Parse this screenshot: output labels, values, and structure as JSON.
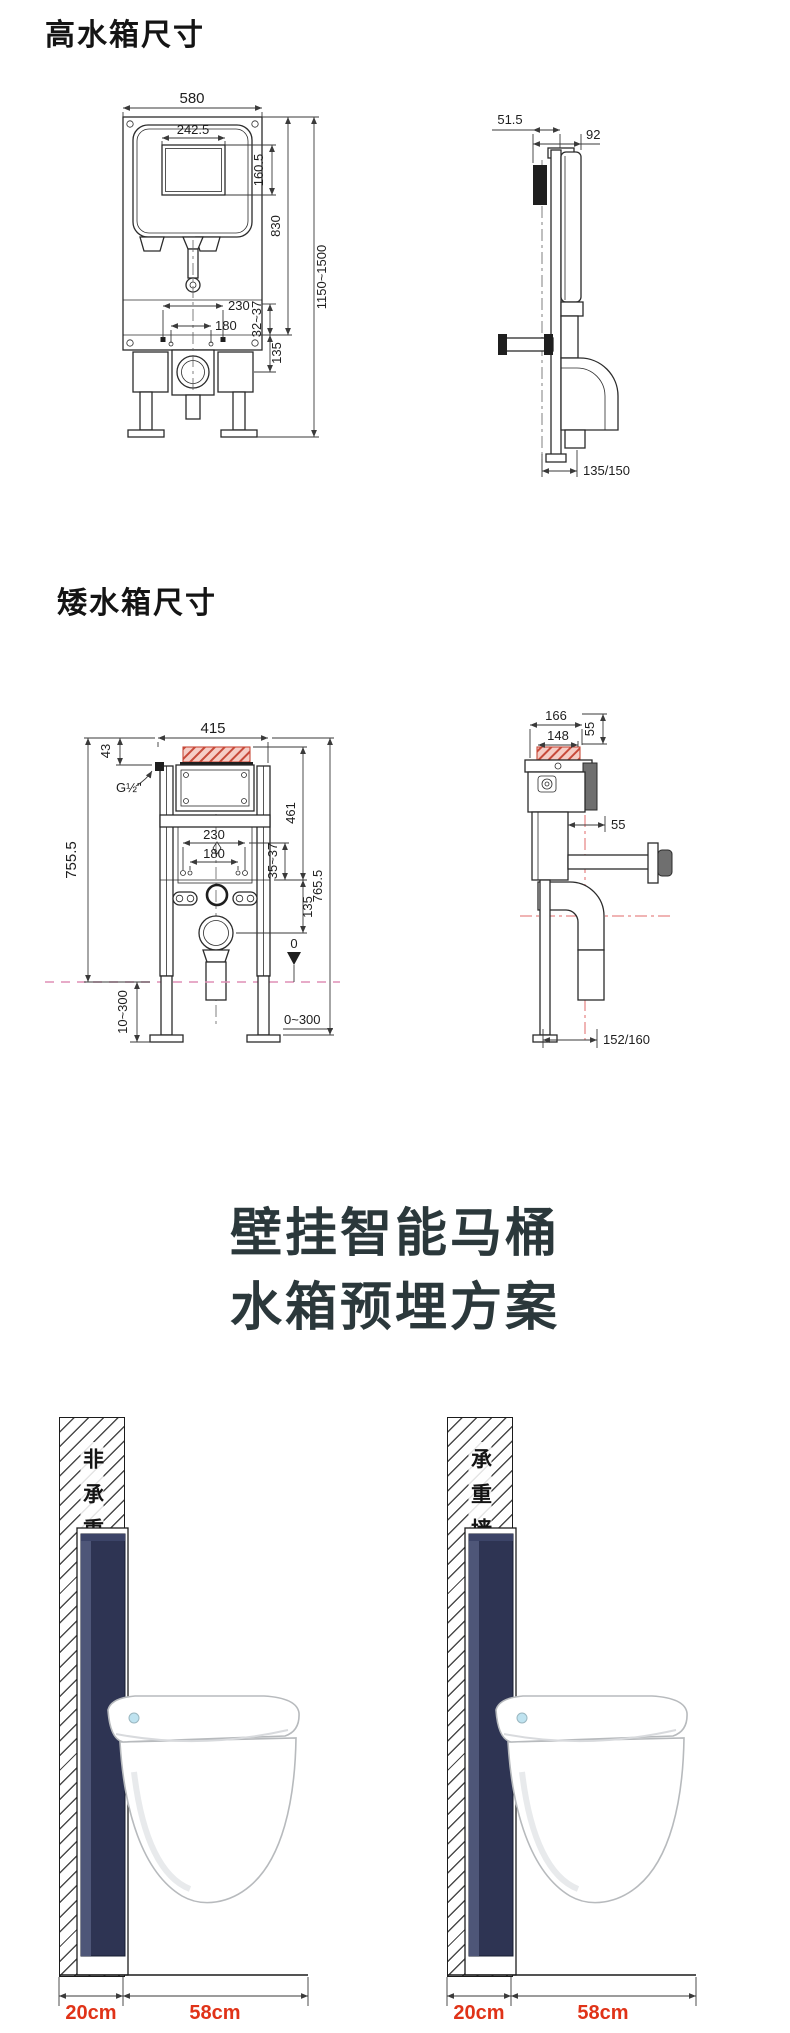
{
  "page": {
    "width": 790,
    "height": 2033
  },
  "high_tank": {
    "section_title": "高水箱尺寸",
    "front_view": {
      "overall_width": "580",
      "window_width": "242.5",
      "window_height": "160.5",
      "frame_height": "830",
      "install_height_range": "1150~1500",
      "bolt_spacing_outer": "230",
      "bolt_spacing_inner": "180",
      "adjust_range": "32~37",
      "rail_to_drain": "135"
    },
    "side_view": {
      "front_depth": "51.5",
      "total_depth": "92",
      "drain_distance": "135/150"
    }
  },
  "low_tank": {
    "section_title": "矮水箱尺寸",
    "front_view": {
      "overall_width": "415",
      "top_offset": "43",
      "inlet_thread": "G½\"",
      "bolt_spacing_outer": "230",
      "bolt_spacing_inner": "180",
      "adjust_range": "35~37",
      "tank_height": "461",
      "height_left": "755.5",
      "height_right": "765.5",
      "rail_to_drain": "135",
      "datum_level": "0",
      "leg_adjust_left": "10~300",
      "leg_adjust_right": "0~300"
    },
    "side_view": {
      "depth_outer": "166",
      "depth_inner": "148",
      "cap_height": "55",
      "rear_offset": "55",
      "drain_distance": "152/160"
    }
  },
  "embed_plan": {
    "title_line1": "壁挂智能马桶",
    "title_line2": "水箱预埋方案",
    "left_scheme": {
      "wall_label": "非承重墙或实心墙",
      "wall_thickness": "20cm",
      "toilet_depth": "58cm"
    },
    "right_scheme": {
      "wall_label": "承重墙或实心墙",
      "wall_thickness": "20cm",
      "toilet_depth": "58cm"
    }
  },
  "colors": {
    "drawing_line": "#2b2b2b",
    "dim_line": "#3a3a3a",
    "accent_red_label": "#e03318",
    "tank_navy": "#2e3453",
    "tank_navy_light": "#4e5678",
    "title_dark": "#2b383b",
    "hatch_red_fill": "#f5cdc6",
    "hatch_red_line": "#c84a3a",
    "pink_dashed": "#df8fb5",
    "red_centerline": "#e06a6a"
  }
}
